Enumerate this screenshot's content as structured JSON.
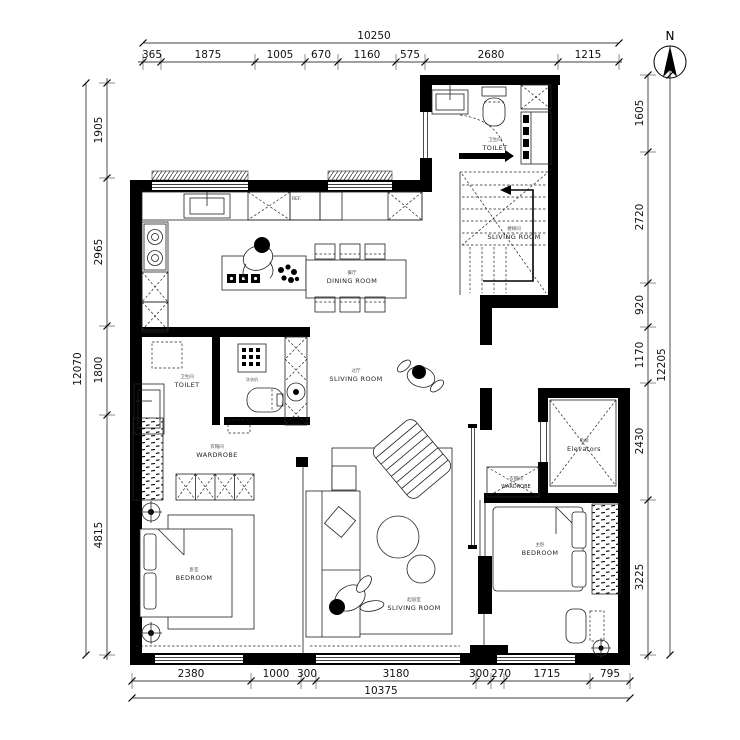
{
  "north_label": "N",
  "dimensions": {
    "top": {
      "total": "10250",
      "segments": [
        "365",
        "1875",
        "1005",
        "670",
        "1160",
        "575",
        "2680",
        "1215"
      ]
    },
    "left": {
      "total": "12070",
      "segments": [
        "1905",
        "2965",
        "1800",
        "4815"
      ]
    },
    "right": {
      "total": "12205",
      "segments": [
        "1605",
        "2720",
        "920",
        "1170",
        "2430",
        "3225"
      ]
    },
    "bottom": {
      "total": "10375",
      "segments": [
        "2380",
        "1000",
        "300",
        "3180",
        "300",
        "270",
        "1715",
        "795"
      ]
    }
  },
  "rooms": {
    "toilet_top": {
      "en": "TOILET",
      "zh": "卫生间"
    },
    "stairwell": {
      "en": "SLIVING ROOM",
      "zh": "楼梯间"
    },
    "dining": {
      "en": "DINING ROOM",
      "zh": "餐厅"
    },
    "hall": {
      "en": "SLIVING ROOM",
      "zh": "过厅"
    },
    "toilet_left": {
      "en": "TOILET",
      "zh": "卫生间"
    },
    "wardrobe_left": {
      "en": "WARDROBE",
      "zh": "衣帽间"
    },
    "bedroom_left": {
      "en": "BEDROOM",
      "zh": "卧室"
    },
    "living": {
      "en": "SLIVING ROOM",
      "zh": "起居室"
    },
    "elevator": {
      "en": "Elevators",
      "zh": "电梯"
    },
    "wardrobe_right": {
      "en": "WARDROBE",
      "zh": "衣帽间"
    },
    "bedroom_right": {
      "en": "BEDROOM",
      "zh": "主卧"
    }
  },
  "appliances": {
    "fridge": "REF.",
    "washer": "洗衣机"
  }
}
